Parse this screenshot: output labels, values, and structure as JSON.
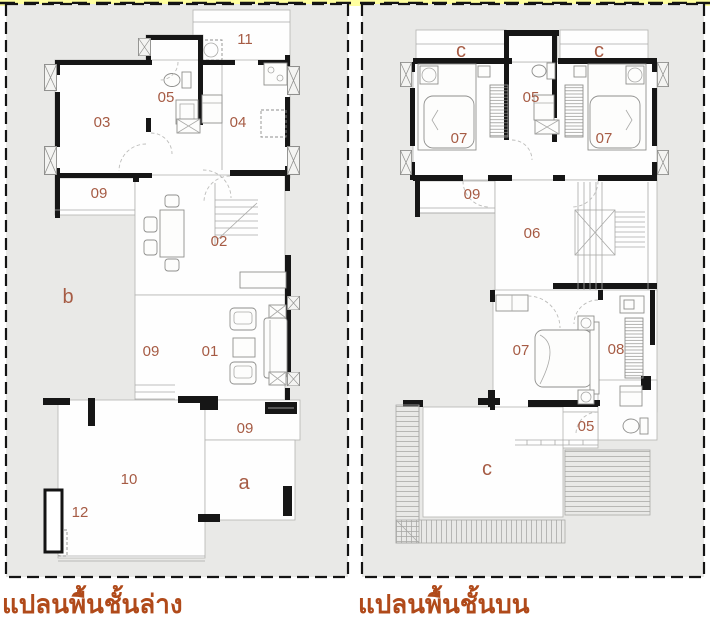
{
  "colors": {
    "page_background": "#ffffff",
    "site_fill": "#e9e9e7",
    "room_fill": "#fefefe",
    "wall": "#161616",
    "boundary_yellow": "#ffffa0",
    "room_label": "#a65b44",
    "title_color": "#b04a1a"
  },
  "plans": [
    {
      "name": "ground-floor",
      "title": "แปลนพื้นชั้นล่าง",
      "labels": [
        {
          "text": "11"
        },
        {
          "text": "05"
        },
        {
          "text": "03"
        },
        {
          "text": "04"
        },
        {
          "text": "09"
        },
        {
          "text": "02"
        },
        {
          "text": "b"
        },
        {
          "text": "09"
        },
        {
          "text": "01"
        },
        {
          "text": "09"
        },
        {
          "text": "10"
        },
        {
          "text": "a"
        },
        {
          "text": "12"
        }
      ]
    },
    {
      "name": "upper-floor",
      "title": "แปลนพื้นชั้นบน",
      "labels": [
        {
          "text": "c"
        },
        {
          "text": "c"
        },
        {
          "text": "05"
        },
        {
          "text": "07"
        },
        {
          "text": "07"
        },
        {
          "text": "09"
        },
        {
          "text": "06"
        },
        {
          "text": "07"
        },
        {
          "text": "08"
        },
        {
          "text": "05"
        },
        {
          "text": "c"
        }
      ]
    }
  ]
}
